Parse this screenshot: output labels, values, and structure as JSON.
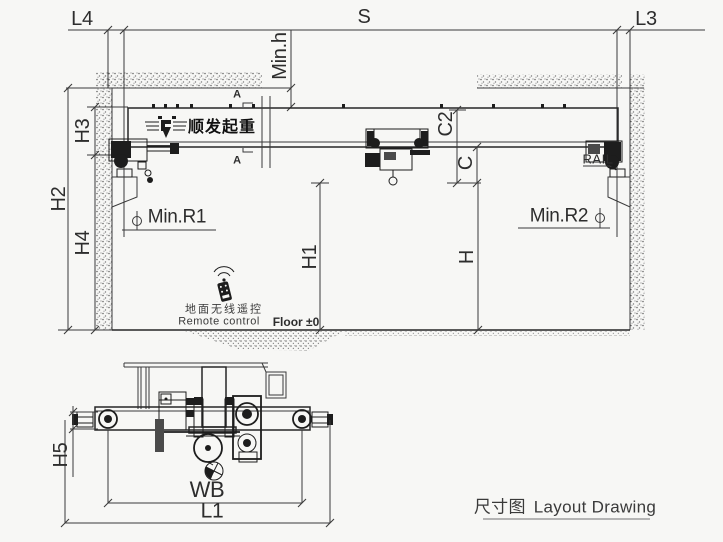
{
  "drawing": {
    "labels": {
      "l4": "L4",
      "s": "S",
      "l3": "L3",
      "min_h": "Min.h",
      "h2": "H2",
      "h3": "H3",
      "h4": "H4",
      "c2": "C2",
      "c": "C",
      "h1": "H1",
      "h": "H",
      "min_r1": "Min.R1",
      "min_r2": "Min.R2",
      "rail": "RAIL",
      "h5": "H5",
      "wb": "WB",
      "l1": "L1",
      "floor": "Floor ±0",
      "section": "A"
    },
    "brand": {
      "logo_text": "顺发起重"
    },
    "remote": {
      "cn": "地面无线遥控",
      "en": "Remote control"
    },
    "title": {
      "cn": "尺寸图",
      "en": "Layout Drawing"
    },
    "colors": {
      "line": "#3a3a3a",
      "dark": "#1d1d1d",
      "bg": "#f7f7f5",
      "text": "#2d2d2d"
    }
  }
}
